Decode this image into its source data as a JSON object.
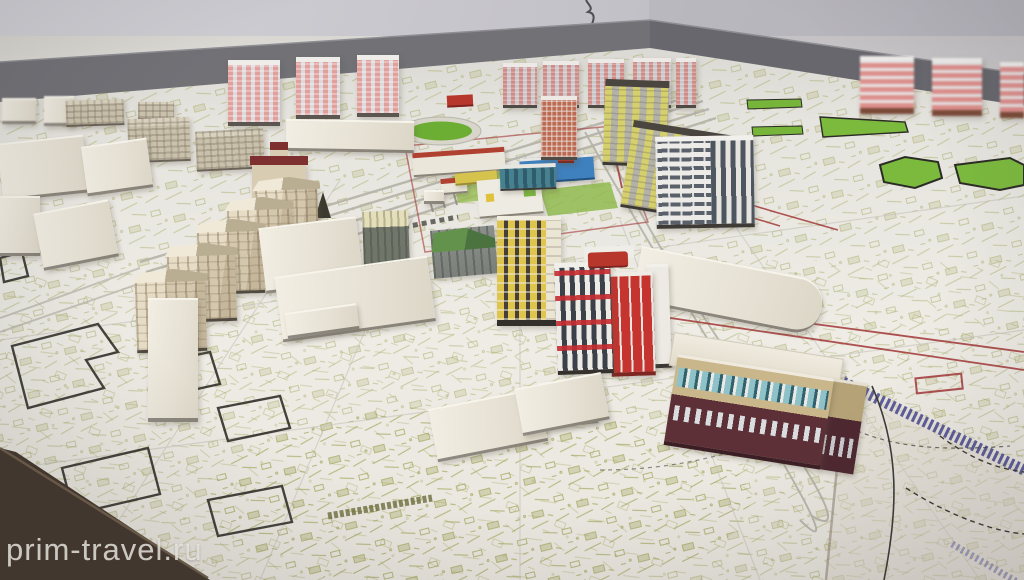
{
  "meta": {
    "type": "photograph",
    "subject": "architectural scale model (maquette) of a planned city district standing on a table covered with a master-plan topographic map sheet",
    "setting": "indoor room, grey wall with dark baseboard behind the model table"
  },
  "watermark": {
    "text": "prim-travel.ru"
  },
  "palette": {
    "wall": "#c6c5cb",
    "baseboard": "#6d6d72",
    "map_paper": "#eeece5",
    "map_lines_olive": "#9aa04e",
    "plan_red_line": "#a23737",
    "plan_green": "#76b43a",
    "railway_blue": "#4f4f94",
    "table_wood": "#43372c",
    "model_cream": "#e9e4d8",
    "tower_pink": "#e2a09c",
    "accent_red": "#c5342e",
    "accent_yellow": "#dfc44e",
    "accent_blue": "#3f80bf",
    "accent_teal": "#47818f",
    "mall_maroon": "#5d3037"
  },
  "scene": {
    "elements": [
      {
        "name": "pink-striped-high-rise-towers-left",
        "count": 3
      },
      {
        "name": "pink-striped-high-rise-towers-right-blurred",
        "count": 3
      },
      {
        "name": "back-row-pink-grid-towers",
        "count": 5
      },
      {
        "name": "red-frame-grid-tower",
        "count": 1
      },
      {
        "name": "yellow-balcony-tower",
        "count": 1
      },
      {
        "name": "yellow-grey-apartment-slabs",
        "count": 2
      },
      {
        "name": "white-office-tower-dark-windows",
        "count": 1
      },
      {
        "name": "school-kindergarten-colored-complex",
        "count": 1
      },
      {
        "name": "green-roof-grey-house",
        "count": 1
      },
      {
        "name": "beige-pitched-roof-apartment-row",
        "count": 5
      },
      {
        "name": "cream-church-with-maroon-roof",
        "count": 1
      },
      {
        "name": "red-white-striped-tower-block",
        "count": 1
      },
      {
        "name": "maroon-tan-shopping-center",
        "count": 1
      },
      {
        "name": "plain-white-massing-blocks",
        "count": 14
      },
      {
        "name": "stadium-green-oval",
        "count": 1
      },
      {
        "name": "green-park-hexagons-and-strips",
        "count": 5
      },
      {
        "name": "blue-hatched-railway-line",
        "count": 1
      },
      {
        "name": "olive-topographic-line-work",
        "count": 1
      },
      {
        "name": "black-footprint-outlines",
        "count": 5
      },
      {
        "name": "red-boundary-lines",
        "count": 6
      },
      {
        "name": "wooden-table-corner",
        "count": 1
      }
    ]
  }
}
